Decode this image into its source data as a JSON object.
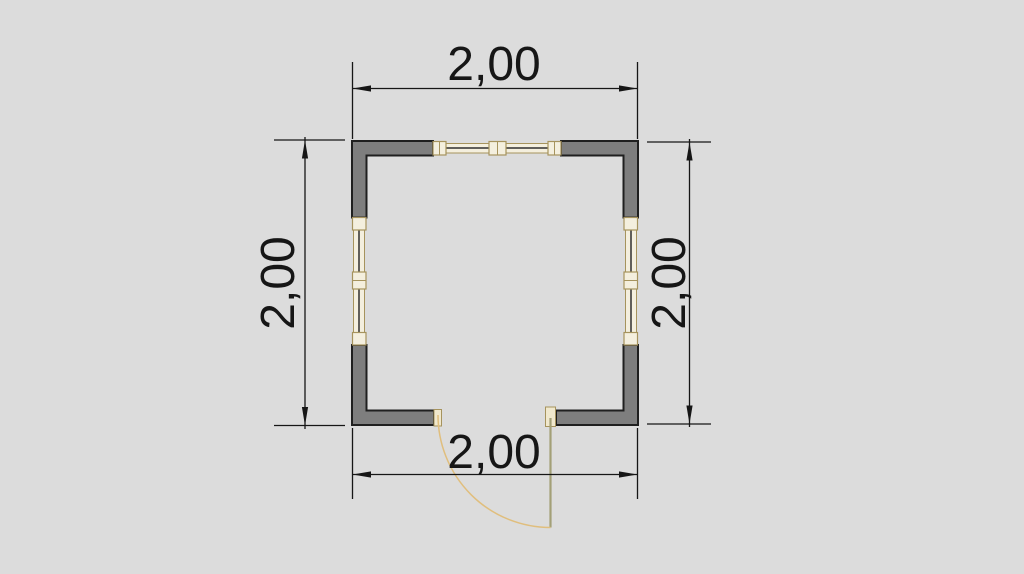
{
  "drawing": {
    "type": "architectural-floor-plan",
    "dimensions": {
      "top": "2,00",
      "bottom": "2,00",
      "left": "2,00",
      "right": "2,00"
    },
    "colors": {
      "background": "#dcdcdc",
      "wall_fill": "#7e7e7e",
      "outline": "#1f1f1f",
      "window_frame": "#a6935d",
      "window_fill": "#f4efde",
      "glass": "#2e2e2e",
      "door_cap": "#f0e8cd",
      "door_leaf": "#a3a077",
      "door_arc": "#e0be7d",
      "dimension": "#161616"
    }
  }
}
